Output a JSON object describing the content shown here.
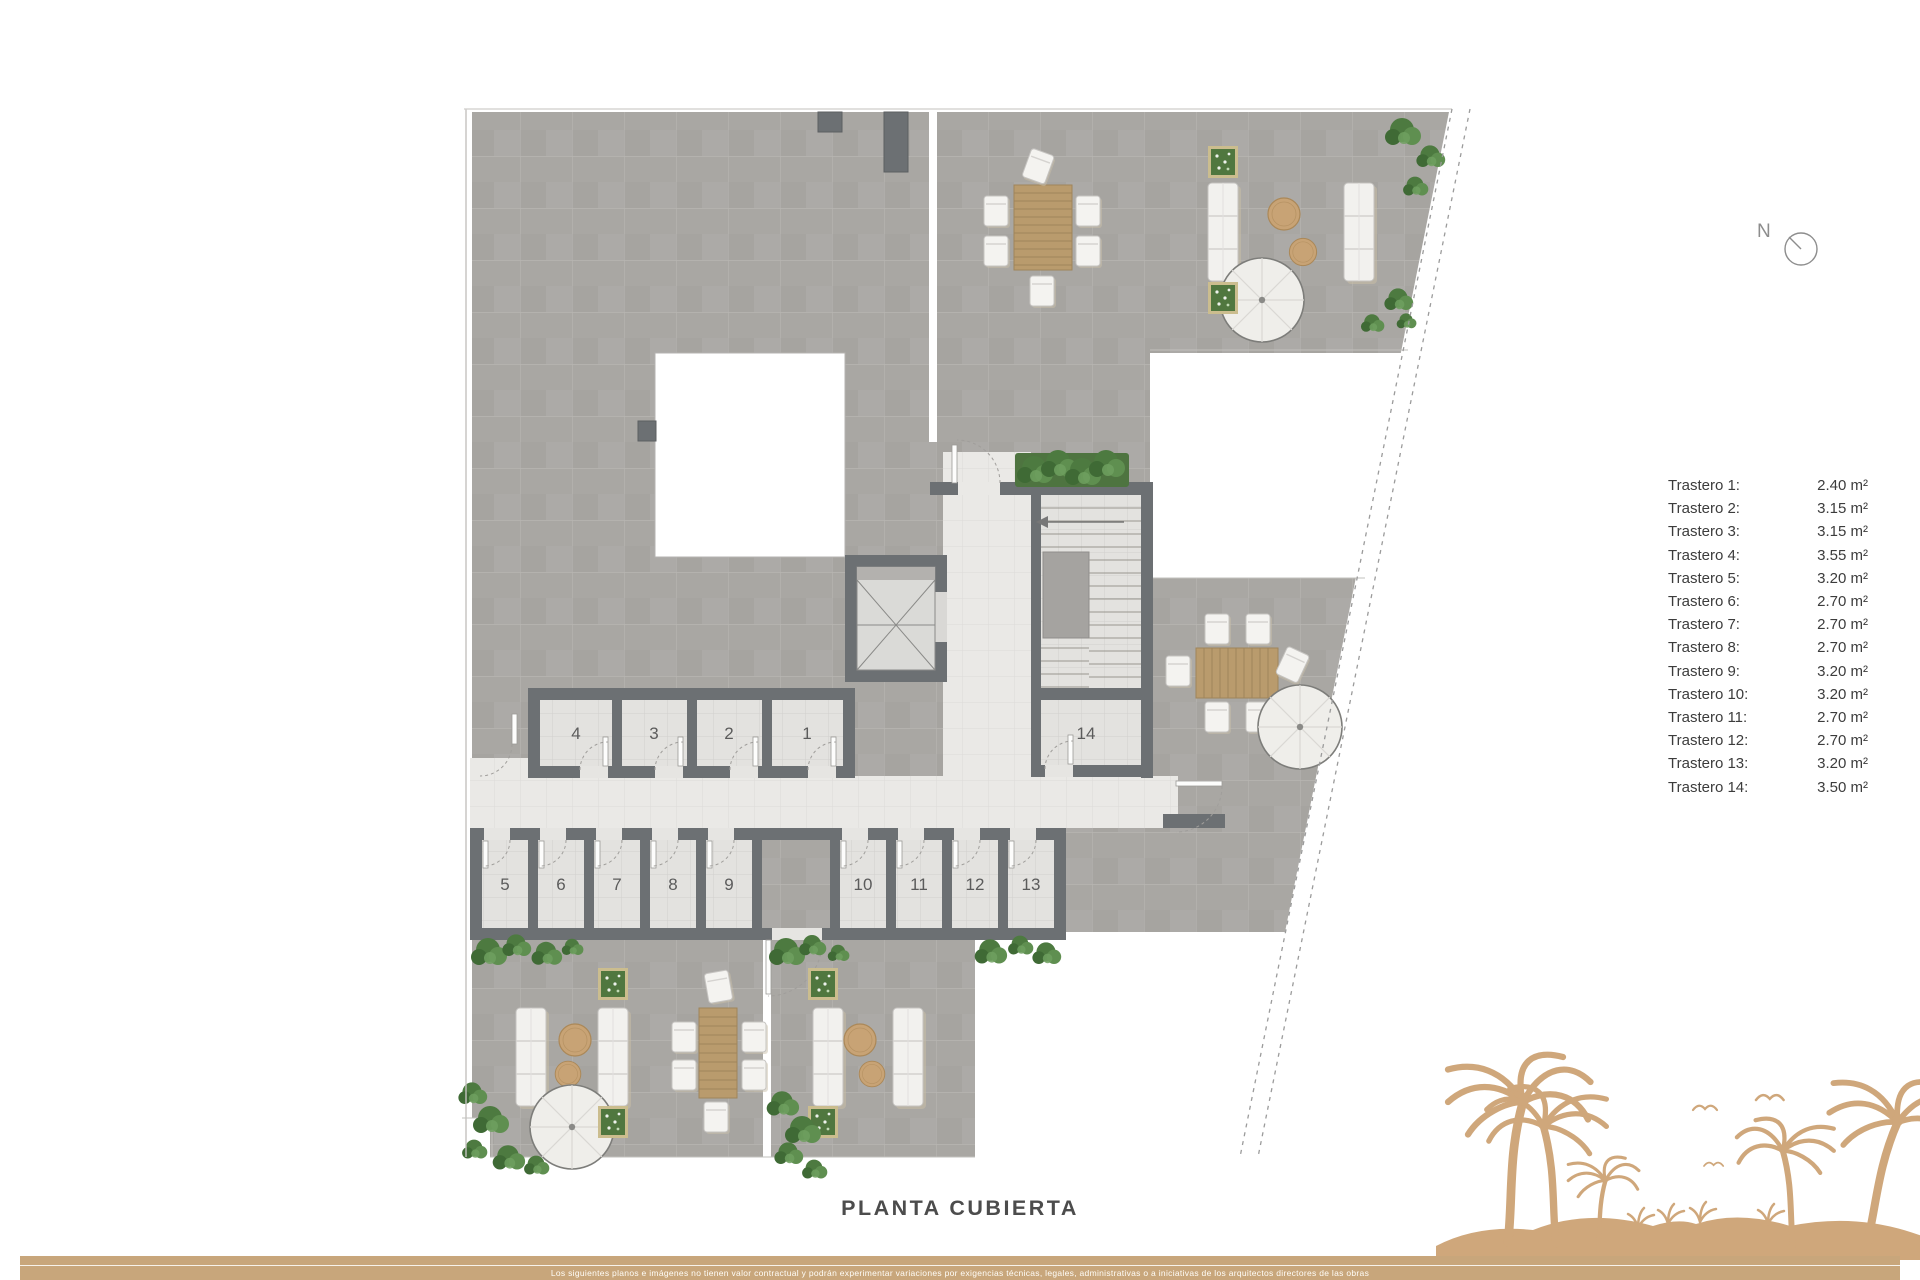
{
  "plan": {
    "title": "PLANTA CUBIERTA",
    "room_labels": [
      "1",
      "2",
      "3",
      "4",
      "5",
      "6",
      "7",
      "8",
      "9",
      "10",
      "11",
      "12",
      "13",
      "14"
    ]
  },
  "compass": {
    "label": "N"
  },
  "legend": {
    "items": [
      {
        "name": "Trastero 1:",
        "area": "2.40 m²"
      },
      {
        "name": "Trastero 2:",
        "area": "3.15 m²"
      },
      {
        "name": "Trastero 3:",
        "area": "3.15 m²"
      },
      {
        "name": "Trastero 4:",
        "area": "3.55 m²"
      },
      {
        "name": "Trastero 5:",
        "area": "3.20 m²"
      },
      {
        "name": "Trastero 6:",
        "area": "2.70 m²"
      },
      {
        "name": "Trastero 7:",
        "area": "2.70 m²"
      },
      {
        "name": "Trastero 8:",
        "area": "2.70 m²"
      },
      {
        "name": "Trastero 9:",
        "area": "3.20 m²"
      },
      {
        "name": "Trastero 10:",
        "area": "3.20 m²"
      },
      {
        "name": "Trastero 11:",
        "area": "2.70 m²"
      },
      {
        "name": "Trastero 12:",
        "area": "2.70 m²"
      },
      {
        "name": "Trastero 13:",
        "area": "3.20 m²"
      },
      {
        "name": "Trastero 14:",
        "area": "3.50 m²"
      }
    ]
  },
  "footer": {
    "disclaimer": "Los siguientes planos e imágenes no tienen valor contractual y podrán experimentar variaciones por exigencias técnicas, legales, administrativas o a iniciativas de los arquitectos directores de las obras"
  },
  "colors": {
    "accent_tan": "#c8a67b",
    "palm_tan": "#cfa77b",
    "wall_gray": "#6c7073",
    "roof_gray": "#a9a7a3",
    "floor_light": "#e6e5e2",
    "plant_green": "#4e7a40",
    "wood": "#b3935f"
  }
}
